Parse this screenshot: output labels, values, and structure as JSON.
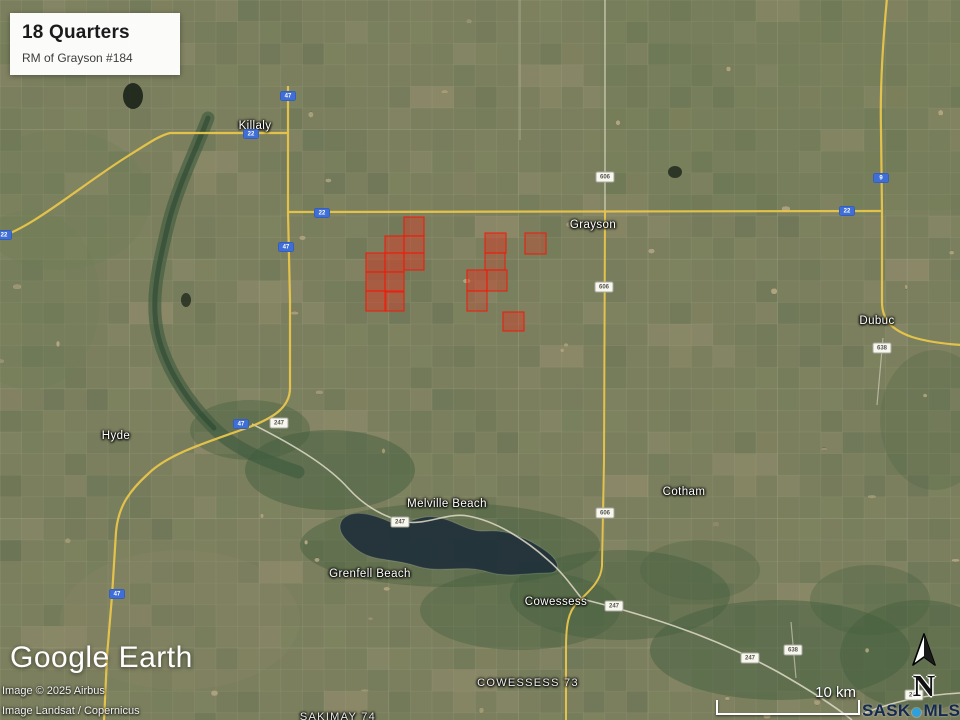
{
  "title_card": {
    "title": "18 Quarters",
    "subtitle": "RM of Grayson #184"
  },
  "branding": {
    "logo": "Google Earth",
    "credit_line1": "Image © 2025 Airbus",
    "credit_line2": "Image Landsat / Copernicus"
  },
  "scale_bar": {
    "label": "10 km"
  },
  "compass": {
    "label": "N"
  },
  "mls_logo": {
    "sask": "SASK",
    "mls": "MLS",
    "registered": "®"
  },
  "map": {
    "colors": {
      "parcel_fill": "#d63c28",
      "parcel_stroke": "#f2190a",
      "highway_yellow": "#e9c64b",
      "road_white": "#e0dbc8",
      "shield_blue": "#3f6fd6",
      "water": "#20303a"
    },
    "places": [
      {
        "name": "Killaly",
        "x": 255,
        "y": 126,
        "type": "town"
      },
      {
        "name": "Grayson",
        "x": 593,
        "y": 225,
        "type": "town"
      },
      {
        "name": "Dubuc",
        "x": 877,
        "y": 321,
        "type": "town"
      },
      {
        "name": "Hyde",
        "x": 116,
        "y": 436,
        "type": "locality"
      },
      {
        "name": "Cotham",
        "x": 684,
        "y": 492,
        "type": "locality"
      },
      {
        "name": "Melville Beach",
        "x": 447,
        "y": 504,
        "type": "locality"
      },
      {
        "name": "Grenfell Beach",
        "x": 370,
        "y": 574,
        "type": "locality"
      },
      {
        "name": "Cowessess",
        "x": 556,
        "y": 602,
        "type": "locality"
      },
      {
        "name": "COWESSESS 73",
        "x": 528,
        "y": 683,
        "type": "reserve"
      },
      {
        "name": "SAKIMAY 74",
        "x": 338,
        "y": 717,
        "type": "reserve"
      }
    ],
    "shields": [
      {
        "label": "47",
        "style": "blue",
        "x": 288,
        "y": 96
      },
      {
        "label": "22",
        "style": "blue",
        "x": 251,
        "y": 134
      },
      {
        "label": "22",
        "style": "blue",
        "x": 4,
        "y": 235
      },
      {
        "label": "22",
        "style": "blue",
        "x": 322,
        "y": 213
      },
      {
        "label": "22",
        "style": "blue",
        "x": 847,
        "y": 211
      },
      {
        "label": "9",
        "style": "blue",
        "x": 881,
        "y": 178
      },
      {
        "label": "47",
        "style": "blue",
        "x": 286,
        "y": 247
      },
      {
        "label": "47",
        "style": "blue",
        "x": 241,
        "y": 424
      },
      {
        "label": "47",
        "style": "blue",
        "x": 117,
        "y": 594
      },
      {
        "label": "606",
        "style": "white",
        "x": 605,
        "y": 177
      },
      {
        "label": "606",
        "style": "white",
        "x": 604,
        "y": 287
      },
      {
        "label": "606",
        "style": "white",
        "x": 605,
        "y": 513
      },
      {
        "label": "247",
        "style": "white",
        "x": 279,
        "y": 423
      },
      {
        "label": "247",
        "style": "white",
        "x": 400,
        "y": 522
      },
      {
        "label": "247",
        "style": "white",
        "x": 614,
        "y": 606
      },
      {
        "label": "247",
        "style": "white",
        "x": 750,
        "y": 658
      },
      {
        "label": "247",
        "style": "white",
        "x": 914,
        "y": 695
      },
      {
        "label": "638",
        "style": "white",
        "x": 882,
        "y": 348
      },
      {
        "label": "638",
        "style": "white",
        "x": 793,
        "y": 650
      }
    ],
    "parcels": [
      {
        "x": 404,
        "y": 217,
        "w": 20,
        "h": 19,
        "o": 0.45
      },
      {
        "x": 385,
        "y": 236,
        "w": 19,
        "h": 17,
        "o": 0.5
      },
      {
        "x": 404,
        "y": 236,
        "w": 20,
        "h": 17,
        "o": 0.45
      },
      {
        "x": 366,
        "y": 253,
        "w": 19,
        "h": 19,
        "o": 0.5
      },
      {
        "x": 385,
        "y": 253,
        "w": 19,
        "h": 19,
        "o": 0.55
      },
      {
        "x": 404,
        "y": 253,
        "w": 20,
        "h": 17,
        "o": 0.5
      },
      {
        "x": 366,
        "y": 272,
        "w": 19,
        "h": 19,
        "o": 0.5
      },
      {
        "x": 385,
        "y": 272,
        "w": 19,
        "h": 19,
        "o": 0.5
      },
      {
        "x": 366,
        "y": 291,
        "w": 20,
        "h": 20,
        "o": 0.5
      },
      {
        "x": 385,
        "y": 292,
        "w": 19,
        "h": 19,
        "o": 0.45
      },
      {
        "x": 485,
        "y": 233,
        "w": 21,
        "h": 20,
        "o": 0.5
      },
      {
        "x": 525,
        "y": 233,
        "w": 21,
        "h": 21,
        "o": 0.35
      },
      {
        "x": 485,
        "y": 253,
        "w": 20,
        "h": 17,
        "o": 0.3
      },
      {
        "x": 467,
        "y": 270,
        "w": 20,
        "h": 21,
        "o": 0.5
      },
      {
        "x": 487,
        "y": 270,
        "w": 20,
        "h": 21,
        "o": 0.4
      },
      {
        "x": 467,
        "y": 291,
        "w": 20,
        "h": 20,
        "o": 0.3
      },
      {
        "x": 503,
        "y": 312,
        "w": 21,
        "h": 19,
        "o": 0.45
      }
    ]
  }
}
